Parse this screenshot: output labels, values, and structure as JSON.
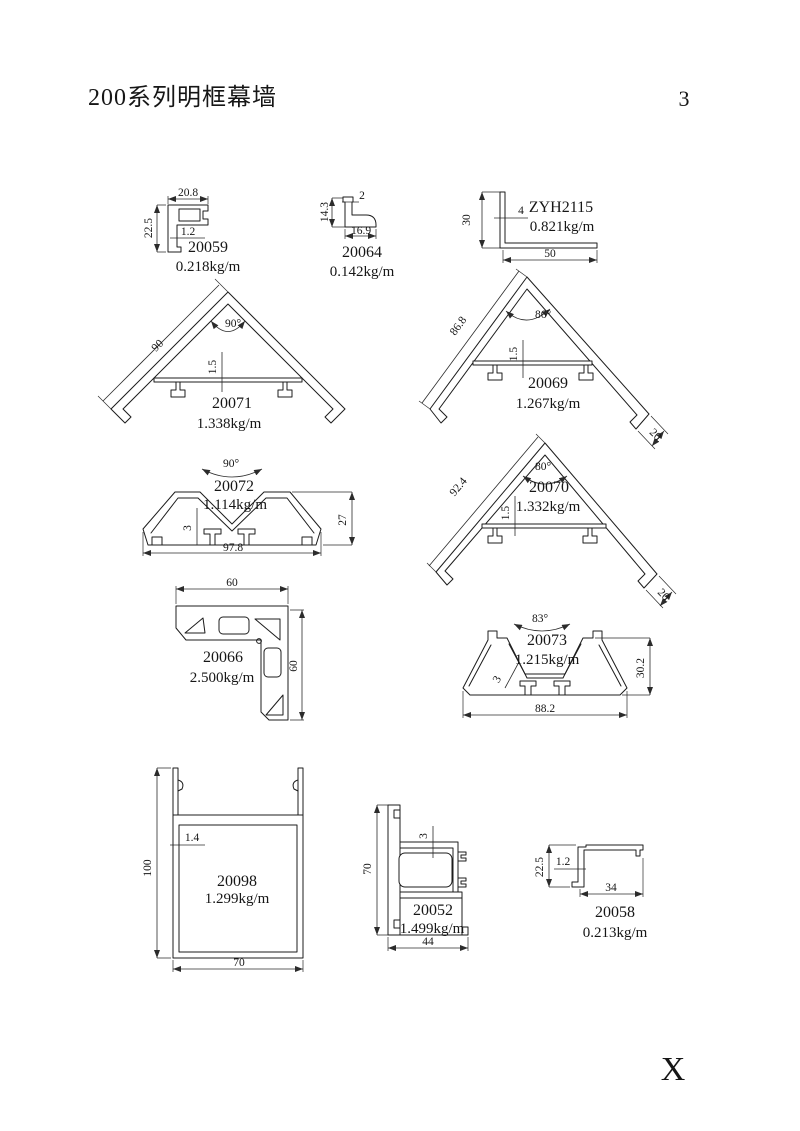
{
  "page": {
    "title": "200系列明框幕墙",
    "number": "3",
    "corner_mark": "X"
  },
  "colors": {
    "ink": "#1c1c1c",
    "background": "#ffffff"
  },
  "profiles": {
    "p20059": {
      "code": "20059",
      "weight": "0.218kg/m",
      "dim_width": "20.8",
      "dim_height": "22.5",
      "dim_thickness": "1.2"
    },
    "p20064": {
      "code": "20064",
      "weight": "0.142kg/m",
      "dim_thickness": "2",
      "dim_height": "14.3",
      "dim_width": "16.9"
    },
    "zyh2115": {
      "code": "ZYH2115",
      "weight": "0.821kg/m",
      "dim_height": "30",
      "dim_thickness": "4",
      "dim_width": "50"
    },
    "p20071": {
      "code": "20071",
      "weight": "1.338kg/m",
      "angle": "90°",
      "dim_side": "90",
      "dim_thickness": "1.5"
    },
    "p20069": {
      "code": "20069",
      "weight": "1.267kg/m",
      "angle": "86°",
      "dim_side": "86.8",
      "dim_thickness": "1.5",
      "dim_leg": "20"
    },
    "p20072": {
      "code": "20072",
      "weight": "1.114kg/m",
      "angle": "90°",
      "dim_thickness": "3",
      "dim_width": "97.8",
      "dim_height": "27"
    },
    "p20070": {
      "code": "20070",
      "weight": "1.332kg/m",
      "angle": "80°",
      "dim_side": "92.4",
      "dim_thickness": "1.5",
      "dim_leg": "20"
    },
    "p20066": {
      "code": "20066",
      "weight": "2.500kg/m",
      "dim_width": "60",
      "dim_height": "60"
    },
    "p20073": {
      "code": "20073",
      "weight": "1.215kg/m",
      "angle": "83°",
      "dim_thickness": "3",
      "dim_width": "88.2",
      "dim_height": "30.2"
    },
    "p20098": {
      "code": "20098",
      "weight": "1.299kg/m",
      "dim_height": "100",
      "dim_thickness": "1.4",
      "dim_width": "70"
    },
    "p20052": {
      "code": "20052",
      "weight": "1.499kg/m",
      "dim_height": "70",
      "dim_thickness": "3",
      "dim_width": "44"
    },
    "p20058": {
      "code": "20058",
      "weight": "0.213kg/m",
      "dim_height": "22.5",
      "dim_thickness": "1.2",
      "dim_width": "34"
    }
  }
}
